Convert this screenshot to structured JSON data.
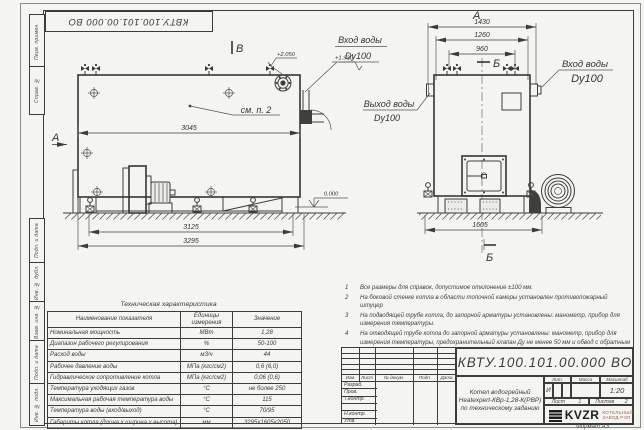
{
  "doc": {
    "number": "КВТУ.100.101.00.000  ВО",
    "format": "Формат  А3"
  },
  "margin": {
    "cells": [
      "Перв. примен.",
      "Справ. №",
      "Подп. и дата",
      "Инв. № дубл.",
      "Взам. инв. №",
      "Подп. и дата",
      "Инв. № подл."
    ]
  },
  "drawing": {
    "side_view": {
      "view_mark_top": "В",
      "view_mark_left": "А",
      "callout": "см. п. 2",
      "dim_body": "3045",
      "dim_frame": "3125",
      "dim_overall": "3295",
      "elev_zero": "0.000",
      "elev_inlet": "+2.050",
      "elev_outlet": "+1.930",
      "inlet_label": "Вход воды",
      "inlet_dn": "Dy100"
    },
    "front_view": {
      "view_mark": "А",
      "section_mark_top": "Б",
      "section_mark_bottom": "Б",
      "dim_width_overall": "1430",
      "dim_width_flanges": "1260",
      "dim_valves": "960",
      "dim_base": "1605",
      "outlet_label": "Выход воды",
      "outlet_dn": "Dy100",
      "inlet_label": "Вход воды",
      "inlet_dn": "Dy100"
    }
  },
  "notes": {
    "items": [
      {
        "n": "1",
        "t": "Все размеры для справок, допустимое отклонение ±100 мм."
      },
      {
        "n": "2",
        "t": "На боковой стенке котла в области топочной камеры установлен противопожарный штуцер"
      },
      {
        "n": "3",
        "t": "На подводящей трубе котла, до запорной арматуры установлены: манометр, прибор для измерения температуры."
      },
      {
        "n": "4",
        "t": "На отводящей трубе котла до запорной арматуры установлены: манометр, прибор для измерения температуры, предохранительный клапан Ду не менее 50 мм и обвод с обратным клапаном Ду не менее 50 мм."
      }
    ]
  },
  "tech": {
    "title": "Техническая характеристика",
    "headers": [
      "Наименование показателя",
      "Единицы измерения",
      "Значение"
    ],
    "rows": [
      [
        "Номинальная мощность",
        "МВт",
        "1,28"
      ],
      [
        "Диапазон рабочего регулирования",
        "%",
        "50-100"
      ],
      [
        "Расход воды",
        "м3/ч",
        "44"
      ],
      [
        "Рабочее давление воды",
        "МПа (кгс/см2)",
        "0,6 (6,0)"
      ],
      [
        "Гидравлическое сопротивление котла",
        "МПа (кгс/см2)",
        "0,06 (0,6)"
      ],
      [
        "Температура уходящих газов",
        "°С",
        "не более 250"
      ],
      [
        "Максимальная рабочая температура воды",
        "°С",
        "115"
      ],
      [
        "Температура воды (вход/выход)",
        "°С",
        "70/95"
      ],
      [
        "Габариты котла (длина х ширина х высота)",
        "мм",
        "3295х1605х2050"
      ]
    ]
  },
  "title_block": {
    "header_cols": [
      "Изм.",
      "Лист",
      "№ докум.",
      "Подп.",
      "Дата"
    ],
    "row_labels": [
      "Разраб.",
      "Пров.",
      "Т.контр.",
      "",
      "Н.контр.",
      "Утв."
    ],
    "name_lines": [
      "Котел водогрейный",
      "Heatexpert-КВр-1,28-К(РВР)",
      "по техническому заданию"
    ],
    "lit_header": "Лит.",
    "mass_header": "Масса",
    "scale_header": "Масштаб",
    "lit_value": "И",
    "scale_value": "1:20",
    "sheet_label": "Лист",
    "sheet_value": "1",
    "sheets_label": "Листов",
    "sheets_value": "2",
    "logo": "KVZR",
    "logo_sub": [
      "КОТЕЛЬНЫЙ",
      "ЗАВОД РЭП"
    ]
  }
}
